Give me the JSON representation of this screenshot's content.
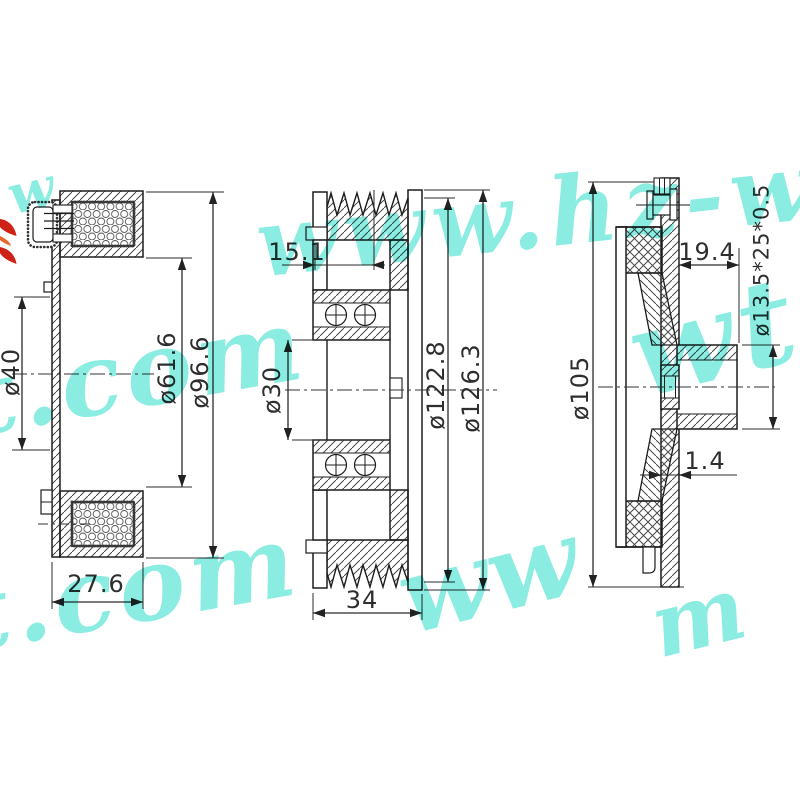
{
  "page": {
    "background": "#ffffff",
    "line_color": "#222222",
    "hatch_color": "#4a4a4a",
    "text_color": "#2e2e2e"
  },
  "watermark": {
    "color": "#6fe8db",
    "fragments": [
      {
        "text": "w"
      },
      {
        "text": "www.hz-wt."
      },
      {
        "text": "t.com"
      },
      {
        "text": "wt"
      },
      {
        "text": "t.com"
      },
      {
        "text": "ww"
      },
      {
        "text": "m"
      }
    ]
  },
  "logo": {
    "colors": [
      "#cf2217",
      "#e8652c"
    ]
  },
  "views": {
    "coil": {
      "dims": {
        "bore": {
          "label": "ø40",
          "value": 40
        },
        "coil_inner": {
          "label": "ø61.6",
          "value": 61.6
        },
        "coil_outer": {
          "label": "ø96.6",
          "value": 96.6
        },
        "depth": {
          "label": "27.6",
          "value": 27.6
        }
      }
    },
    "pulley": {
      "dims": {
        "groove_offset": {
          "label": "15.1",
          "value": 15.1
        },
        "bore": {
          "label": "ø30",
          "value": 30
        },
        "groove_root_diameter": {
          "label": "ø122.8",
          "value": 122.8
        },
        "outer_diameter": {
          "label": "ø126.3",
          "value": 126.3
        },
        "width": {
          "label": "34",
          "value": 34
        }
      }
    },
    "hub": {
      "dims": {
        "outer_diameter": {
          "label": "ø105",
          "value": 105
        },
        "boss_length": {
          "label": "19.4",
          "value": 19.4
        },
        "shaft_spec": {
          "label": "ø13.5*25*0.5"
        },
        "plate_thickness": {
          "label": "1.4",
          "value": 1.4
        }
      }
    }
  }
}
